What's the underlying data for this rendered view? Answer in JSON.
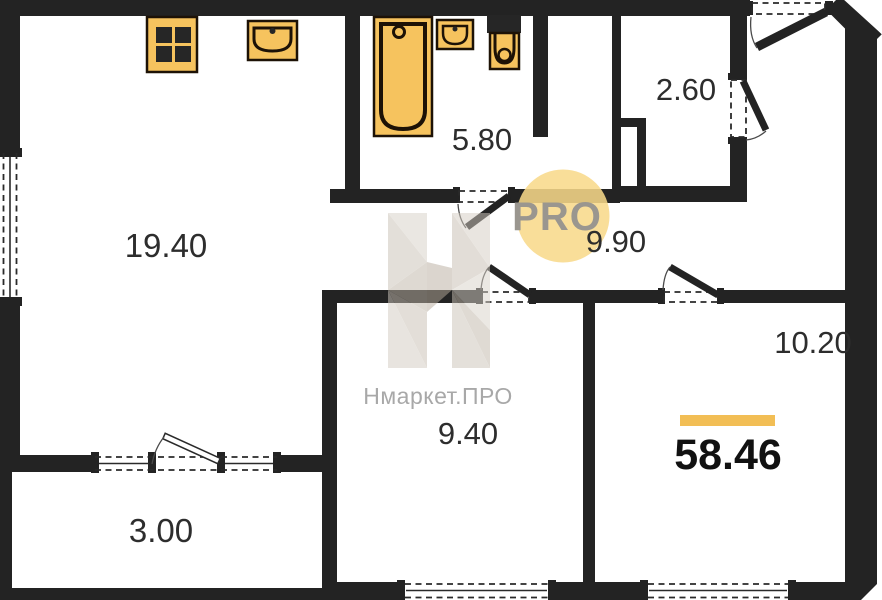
{
  "plan": {
    "rooms": [
      {
        "name": "living-room",
        "area": "19.40"
      },
      {
        "name": "bathroom",
        "area": "5.80"
      },
      {
        "name": "storage",
        "area": "2.60"
      },
      {
        "name": "hallway",
        "area": "9.90"
      },
      {
        "name": "bedroom",
        "area": "10.20"
      },
      {
        "name": "room",
        "area": "9.40"
      },
      {
        "name": "balcony",
        "area": "3.00"
      }
    ],
    "total_area": "58.46"
  },
  "watermark": {
    "brand": "Нмаркет.ПРО",
    "badge": "PRO"
  },
  "colors": {
    "wall": "#232323",
    "fixture_fill": "#f6c35e",
    "fixture_stroke": "#1d1206",
    "accent_bar": "#f2be55",
    "badge_bg": "#f8d98a",
    "badge_text": "#9a968f",
    "watermark": "#cfc5b9",
    "label_text": "#2d2d2d",
    "brand_text": "#a8a8a8"
  }
}
